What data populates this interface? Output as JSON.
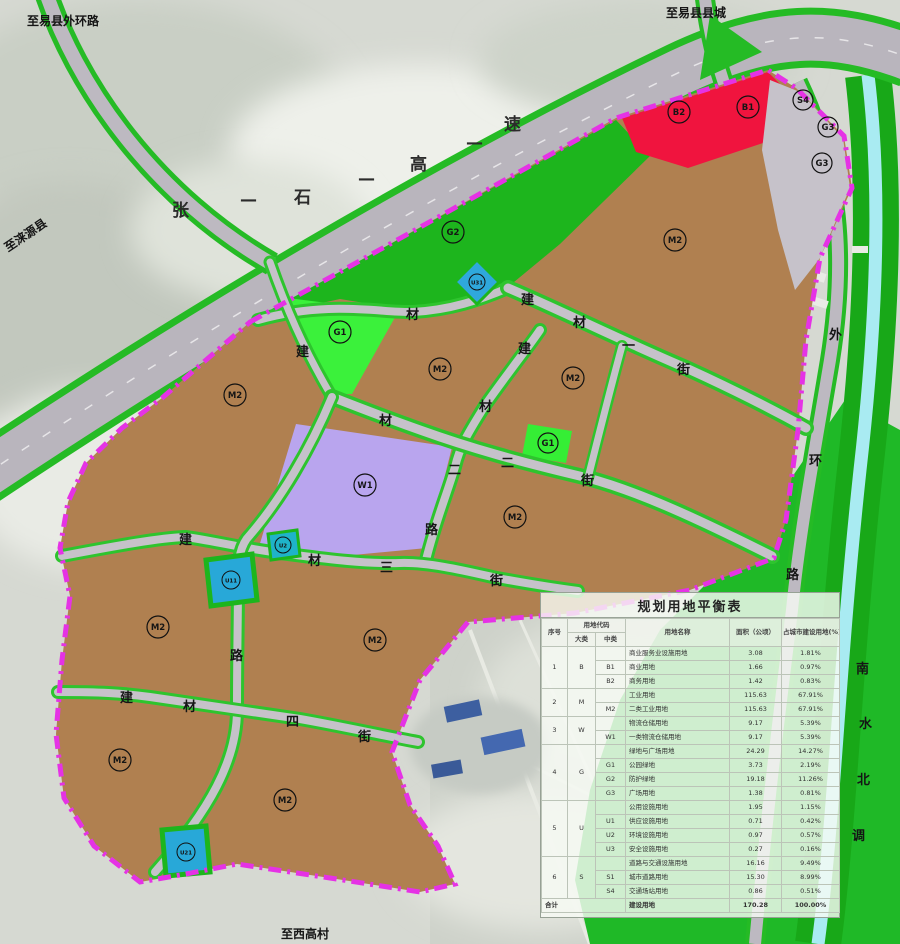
{
  "map": {
    "edge_labels": {
      "top_left": "至易县外环路",
      "top_right": "至易县县城",
      "left": "至涞源县",
      "bottom": "至西高村"
    },
    "roads": {
      "highway": [
        "张",
        "石",
        "高",
        "速"
      ],
      "dash": "—",
      "street1": [
        "建",
        "材",
        "一",
        "街"
      ],
      "road2": [
        "建",
        "材",
        "二",
        "路"
      ],
      "street2": [
        "材",
        "二",
        "街"
      ],
      "street3": [
        "建",
        "材",
        "三",
        "街"
      ],
      "street4": [
        "建",
        "材",
        "四",
        "街"
      ],
      "road1_char": "材",
      "nw_arm_char": "建",
      "west_road_char": "路",
      "ring": [
        "外",
        "环",
        "路"
      ],
      "canal": [
        "南",
        "水",
        "北",
        "调"
      ]
    },
    "zones": {
      "m2": "M2",
      "w1": "W1",
      "g1": "G1",
      "g2": "G2",
      "g3": "G3",
      "b1": "B1",
      "b2": "B2",
      "s4": "S4",
      "u11": "U11",
      "u21": "U21",
      "u31": "U31",
      "u2": "U2"
    },
    "colors": {
      "industrial": "#b08050",
      "logistics": "#b9a5ee",
      "park_green": "#3bf13b",
      "protect_green": "#1db51d",
      "commercial_red": "#f0143e",
      "boundary_magenta": "#e532e5",
      "canal_cyan": "#a9ebf2",
      "utility_blue": "#28a8d8"
    }
  },
  "table": {
    "title": "规划用地平衡表",
    "headers": {
      "ser": "序号",
      "code": "用地代码",
      "major": "大类",
      "mid": "中类",
      "name": "用地名称",
      "area": "面积（公顷）",
      "pct": "占城市建设用地(%)"
    },
    "groups": [
      {
        "ser": "1",
        "major": "B",
        "rows": [
          {
            "mid": "",
            "name": "商业服务业设施用地",
            "area": "3.08",
            "pct": "1.81%"
          },
          {
            "mid": "B1",
            "name": "商业用地",
            "area": "1.66",
            "pct": "0.97%"
          },
          {
            "mid": "B2",
            "name": "商务用地",
            "area": "1.42",
            "pct": "0.83%"
          }
        ]
      },
      {
        "ser": "2",
        "major": "M",
        "rows": [
          {
            "mid": "",
            "name": "工业用地",
            "area": "115.63",
            "pct": "67.91%"
          },
          {
            "mid": "M2",
            "name": "二类工业用地",
            "area": "115.63",
            "pct": "67.91%"
          }
        ]
      },
      {
        "ser": "3",
        "major": "W",
        "rows": [
          {
            "mid": "",
            "name": "物流仓储用地",
            "area": "9.17",
            "pct": "5.39%"
          },
          {
            "mid": "W1",
            "name": "一类物流仓储用地",
            "area": "9.17",
            "pct": "5.39%"
          }
        ]
      },
      {
        "ser": "4",
        "major": "G",
        "rows": [
          {
            "mid": "",
            "name": "绿地与广场用地",
            "area": "24.29",
            "pct": "14.27%"
          },
          {
            "mid": "G1",
            "name": "公园绿地",
            "area": "3.73",
            "pct": "2.19%"
          },
          {
            "mid": "G2",
            "name": "防护绿地",
            "area": "19.18",
            "pct": "11.26%"
          },
          {
            "mid": "G3",
            "name": "广场用地",
            "area": "1.38",
            "pct": "0.81%"
          }
        ]
      },
      {
        "ser": "5",
        "major": "U",
        "rows": [
          {
            "mid": "",
            "name": "公用设施用地",
            "area": "1.95",
            "pct": "1.15%"
          },
          {
            "mid": "U1",
            "name": "供应设施用地",
            "area": "0.71",
            "pct": "0.42%"
          },
          {
            "mid": "U2",
            "name": "环境设施用地",
            "area": "0.97",
            "pct": "0.57%"
          },
          {
            "mid": "U3",
            "name": "安全设施用地",
            "area": "0.27",
            "pct": "0.16%"
          }
        ]
      },
      {
        "ser": "6",
        "major": "S",
        "rows": [
          {
            "mid": "",
            "name": "道路与交通设施用地",
            "area": "16.16",
            "pct": "9.49%"
          },
          {
            "mid": "S1",
            "name": "城市道路用地",
            "area": "15.30",
            "pct": "8.99%"
          },
          {
            "mid": "S4",
            "name": "交通场站用地",
            "area": "0.86",
            "pct": "0.51%"
          }
        ]
      }
    ],
    "total": {
      "label": "合计",
      "name": "建设用地",
      "area": "170.28",
      "pct": "100.00%"
    }
  }
}
